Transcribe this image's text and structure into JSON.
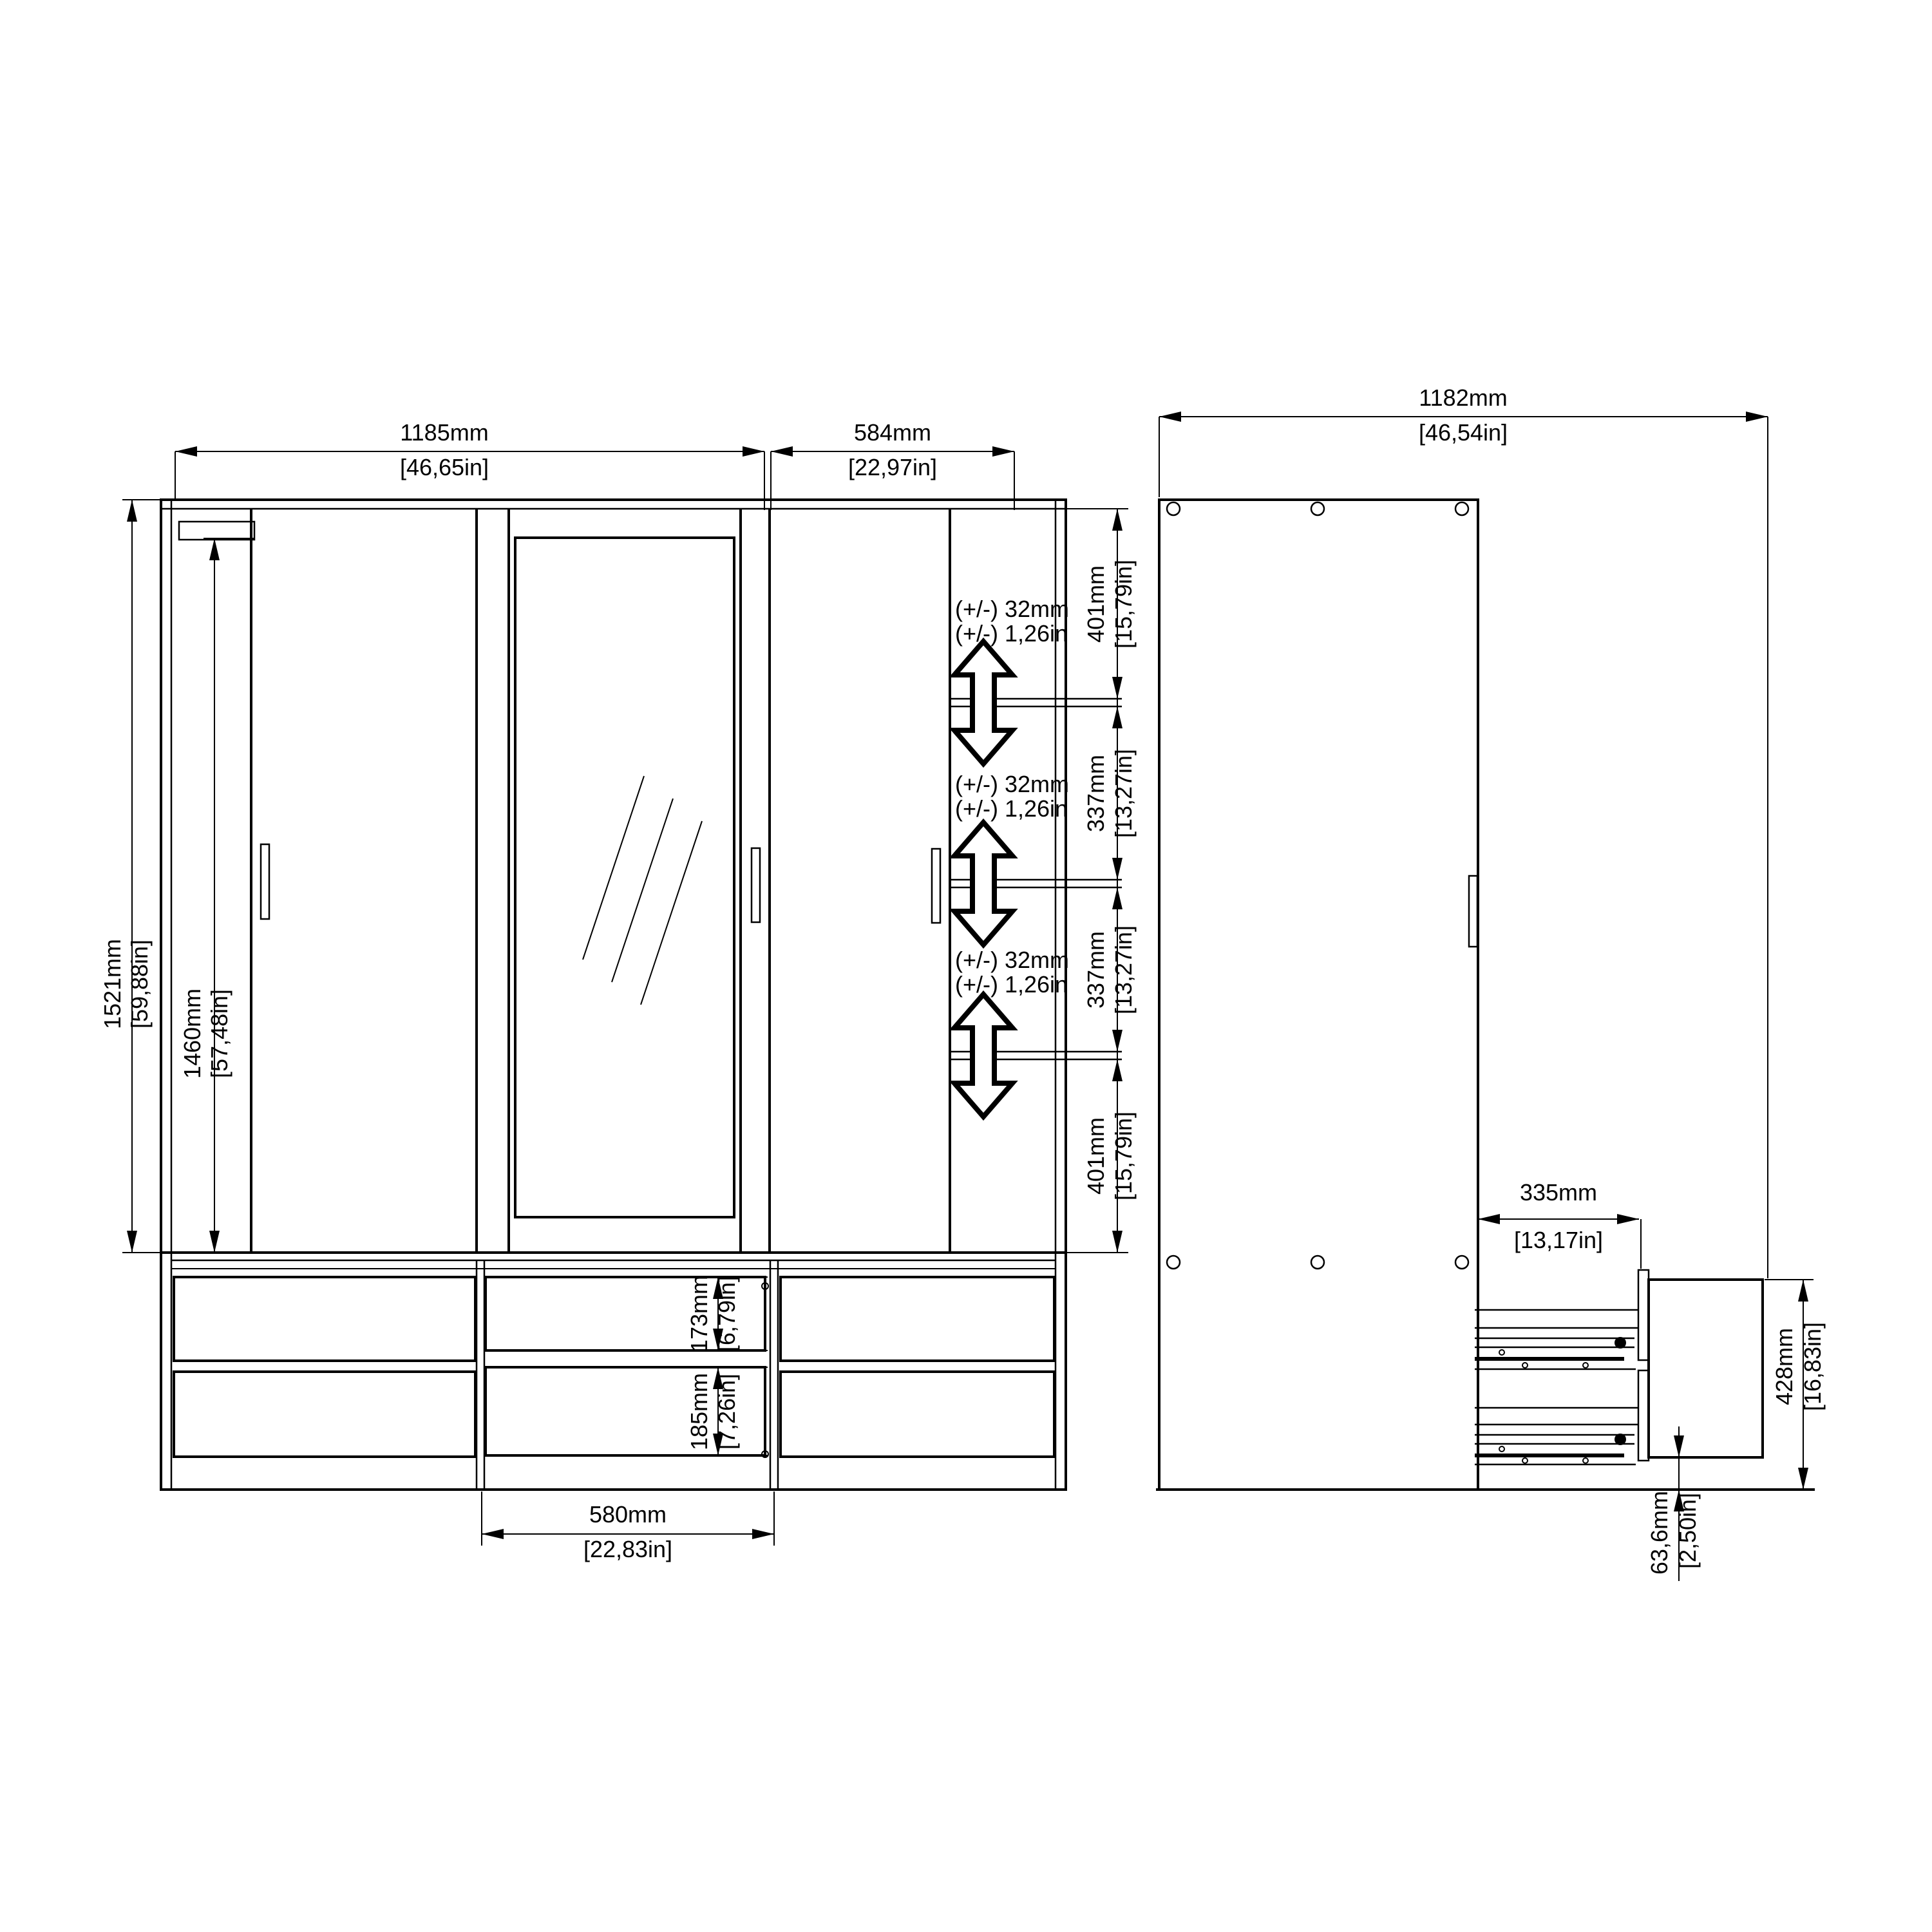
{
  "drawing": {
    "background": "#ffffff",
    "line_color": "#000000",
    "subject": "wardrobe technical drawing, front and side views"
  },
  "front_view": {
    "width_section_left": {
      "mm": "1185mm",
      "in": "[46,65in]"
    },
    "width_section_right": {
      "mm": "584mm",
      "in": "[22,97in]"
    },
    "height_overall": {
      "mm": "1521mm",
      "in": "[59,88in]"
    },
    "height_door": {
      "mm": "1460mm",
      "in": "[57,48in]"
    },
    "shelf_segments": [
      {
        "mm": "401mm",
        "in": "[15,79in]"
      },
      {
        "mm": "337mm",
        "in": "[13,27in]"
      },
      {
        "mm": "337mm",
        "in": "[13,27in]"
      },
      {
        "mm": "401mm",
        "in": "[15,79in]"
      }
    ],
    "shelf_adjustability": {
      "mm": "(+/-) 32mm",
      "in": "(+/-) 1,26in"
    },
    "drawer_front_top": {
      "mm": "173mm",
      "in": "[6,79in]"
    },
    "drawer_front_bottom": {
      "mm": "185mm",
      "in": "[7,26in]"
    },
    "drawer_width": {
      "mm": "580mm",
      "in": "[22,83in]"
    }
  },
  "side_view": {
    "depth_with_drawer_open": {
      "mm": "1182mm",
      "in": "[46,54in]"
    },
    "drawer_depth": {
      "mm": "335mm",
      "in": "[13,17in]"
    },
    "drawer_unit_height": {
      "mm": "428mm",
      "in": "[16,83in]"
    },
    "plinth_gap": {
      "mm": "63,6mm",
      "in": "[2,50in]"
    }
  }
}
